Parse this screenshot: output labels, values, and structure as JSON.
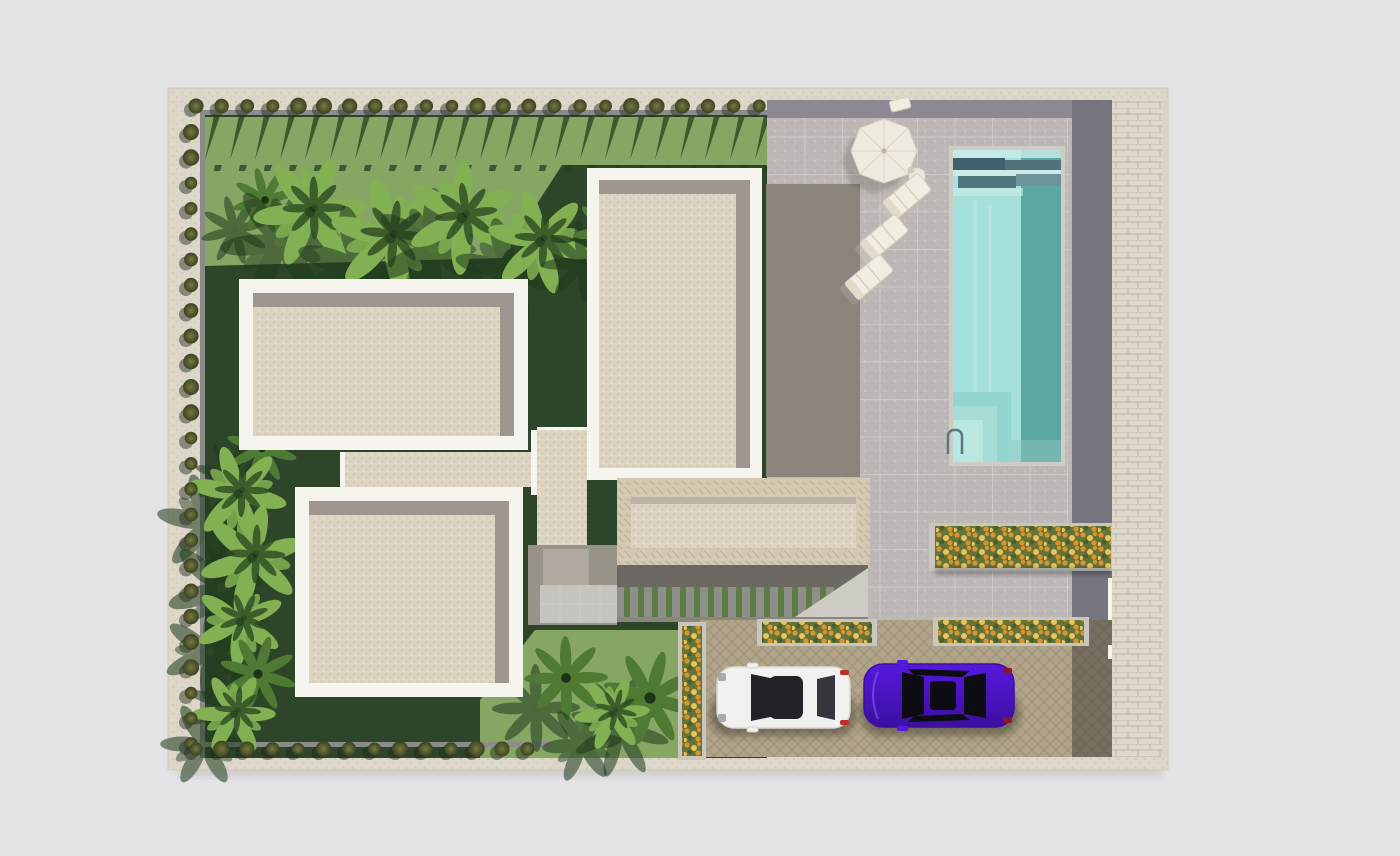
{
  "meta": {
    "description": "Top-down 3D architectural site-plan rendering of a modern villa: flat beige roofs with white parapets, landscaped garden with palms and hedge borders, paved pool terrace with parasol and sun loungers, turquoise swimming pool, flower planters, cobblestone driveway with two parked cars, and a light cobble walkway along the right edge."
  },
  "palette": {
    "pageBg": "#e3e3e5",
    "sheet": "#dcd7c9",
    "sheetDot": "#c9c3b2",
    "grassDark": "#2d4629",
    "grassLight": "#85a763",
    "zigShadow": "#24401f",
    "wallGray": "#8b8b89",
    "bushCore": "#77793f",
    "bushEdge": "#3b4222",
    "bushShadow": "#1c2b18",
    "parapetWhite": "#f6f4ee",
    "roofBeige": "#ddd4c2",
    "roofSpeck": "#c8bda9",
    "roofShadow": "#9d978f",
    "stoneParapet": "#d3c8b2",
    "stoneLine": "#b4a88f",
    "darkTerrace": "#8a847c",
    "patio": "#bdb8b5",
    "patioSpeck": "#a9a4a1",
    "patioLine": "#d4d2ce",
    "bandDark": "#8d8992",
    "bandBlue": "#75747f",
    "poolCoping": "#cfccc6",
    "pool": "#a5e0da",
    "poolDeep": "#57a39f",
    "poolDark": "#40616c",
    "poolPale": "#cdece8",
    "poolStep1": "#93d6cf",
    "poolStep2": "#a6ded7",
    "poolStep3": "#b9e8e1",
    "ladderGray": "#5f7680",
    "walkway": "#ded9cb",
    "walkwayLine": "#b9b1a0",
    "cobble": "#b1a389",
    "cobbleLine": "#8f8268",
    "stripeGreen": "#5d7b45",
    "stripePaver": "#908e89",
    "shadowBand": "#6c6862",
    "underStrip": "#8a867f",
    "courtyard": "#979389",
    "courtTile": "#c6c4bf",
    "courtMat": "#b0a99f",
    "lightTri": "#cecbc4",
    "flowerBase": "#657238",
    "flowerOrange": "#d8952f",
    "flowerYellow": "#e9c45c",
    "flowerGreen": "#47602e",
    "planterCurb": "#c9c6c0",
    "umbrella": "#eeeadf",
    "umbrellaLine": "#d9d2c4",
    "lounger": "#f1ede3",
    "loungerLine": "#d6cfbe",
    "tableTop": "#eae6dc",
    "carWhite": "#f1f1ef",
    "carWhiteEdge": "#d8d8d4",
    "carPurple": "#5519dd",
    "carPurpleDeep": "#3c0fa0",
    "glassDark": "#202327",
    "glassRear": "#34383c",
    "tailRed": "#c03028",
    "headlight": "#9aa0a4",
    "palmBright": "#82b052",
    "palmMid": "#4e7a33",
    "palmDark": "#2c4a22",
    "palmShadow": "#1f3a1c"
  },
  "scene": {
    "buildings": {
      "count": 4,
      "roof_style": "flat beige gravel with white parapet",
      "lower_wing_parapet": "stone clad"
    },
    "pool": {
      "count": 1,
      "shape": "rectangular",
      "water": "turquoise",
      "steps": "bottom-left",
      "ladder": "left edge"
    },
    "furniture": {
      "parasol": 1,
      "sun_loungers": 3,
      "side_table": 1
    },
    "cars": [
      {
        "label": "white-car"
      },
      {
        "label": "purple-car"
      }
    ],
    "planters": {
      "count": 4,
      "flowers": "orange and yellow"
    },
    "hedges": {
      "top": {
        "x0": 196,
        "y": 106,
        "step": 25.6,
        "count": 23
      },
      "left": {
        "x": 191,
        "y0": 132,
        "step": 25.5,
        "count": 25
      },
      "bottom": {
        "x0": 196,
        "y": 749,
        "step": 25.5,
        "count": 14
      }
    },
    "palms": [
      {
        "x": 265,
        "y": 200,
        "s": 1.1,
        "v": "palm"
      },
      {
        "x": 310,
        "y": 212,
        "s": 1.5,
        "v": "banana"
      },
      {
        "x": 390,
        "y": 238,
        "s": 1.6,
        "v": "banana"
      },
      {
        "x": 462,
        "y": 218,
        "s": 1.5,
        "v": "banana"
      },
      {
        "x": 540,
        "y": 242,
        "s": 1.4,
        "v": "banana"
      },
      {
        "x": 612,
        "y": 232,
        "s": 1.3,
        "v": "palm"
      },
      {
        "x": 262,
        "y": 448,
        "s": 1.2,
        "v": "palm"
      },
      {
        "x": 238,
        "y": 494,
        "s": 1.3,
        "v": "banana"
      },
      {
        "x": 252,
        "y": 558,
        "s": 1.4,
        "v": "banana"
      },
      {
        "x": 240,
        "y": 622,
        "s": 1.2,
        "v": "banana"
      },
      {
        "x": 258,
        "y": 674,
        "s": 1.3,
        "v": "palm"
      },
      {
        "x": 234,
        "y": 714,
        "s": 1.1,
        "v": "banana"
      },
      {
        "x": 566,
        "y": 678,
        "s": 1.4,
        "v": "palm"
      },
      {
        "x": 650,
        "y": 698,
        "s": 1.6,
        "v": "palm"
      },
      {
        "x": 612,
        "y": 714,
        "s": 1.0,
        "v": "banana"
      }
    ],
    "patio_grid": {
      "x0": 805,
      "x1": 1070,
      "y0": 137,
      "y1": 618,
      "step": 37.5,
      "left": 769,
      "right": 1070
    }
  }
}
